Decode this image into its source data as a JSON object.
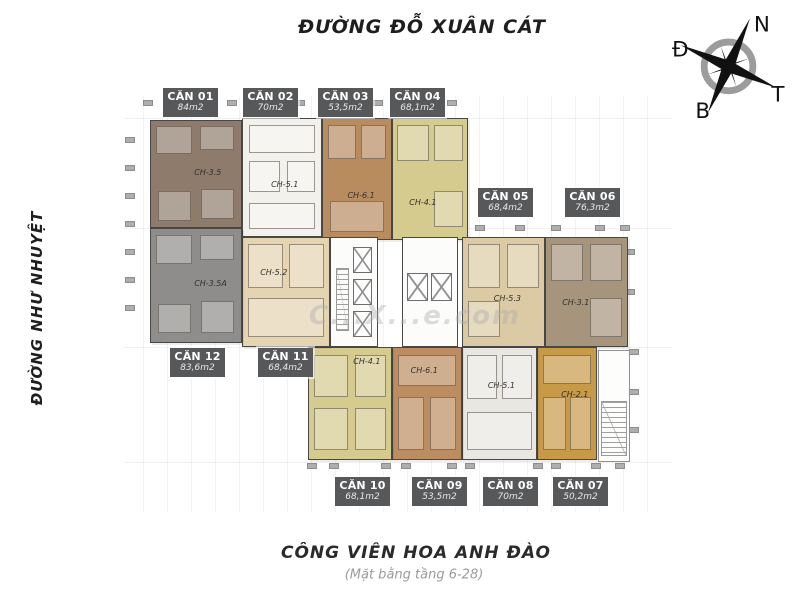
{
  "streets": {
    "top": "ĐƯỜNG ĐỖ XUÂN CÁT",
    "left": "ĐƯỜNG NHƯ NHUYỆT",
    "park": "CÔNG VIÊN HOA ANH ĐÀO",
    "floor_note": "(Mặt bằng tầng 6-28)"
  },
  "compass": {
    "label_top": "N",
    "label_left": "Đ",
    "label_right": "T",
    "label_bottom": "B"
  },
  "watermark": {
    "text": "C...X...e.com"
  },
  "palette": {
    "label_box": "#57585a",
    "wall": "#474747",
    "tick": "#aeaeae"
  },
  "units": [
    {
      "id": "01",
      "name": "CĂN 01",
      "area": "84m2",
      "code": "CH-3.5",
      "label": {
        "x": 163,
        "y": 88
      },
      "plan": {
        "x": 150,
        "y": 120,
        "w": 92,
        "h": 108,
        "color": "#8e7b6b"
      },
      "code_pos": {
        "l": 48,
        "t": 44
      },
      "rooms": [
        [
          6,
          5,
          40,
          26
        ],
        [
          54,
          5,
          38,
          22
        ],
        [
          8,
          66,
          36,
          28
        ],
        [
          56,
          64,
          36,
          28
        ]
      ]
    },
    {
      "id": "02",
      "name": "CĂN 02",
      "area": "70m2",
      "code": "CH-5.1",
      "label": {
        "x": 243,
        "y": 88
      },
      "plan": {
        "x": 242,
        "y": 118,
        "w": 80,
        "h": 119,
        "color": "#f3f1ec"
      },
      "code_pos": {
        "l": 36,
        "t": 52
      },
      "rooms": [
        [
          8,
          5,
          84,
          24
        ],
        [
          8,
          36,
          40,
          26
        ],
        [
          56,
          36,
          36,
          26
        ],
        [
          8,
          72,
          84,
          22
        ]
      ]
    },
    {
      "id": "03",
      "name": "CĂN 03",
      "area": "53,5m2",
      "code": "CH-6.1",
      "label": {
        "x": 318,
        "y": 88
      },
      "plan": {
        "x": 322,
        "y": 118,
        "w": 70,
        "h": 122,
        "color": "#b98c60"
      },
      "code_pos": {
        "l": 36,
        "t": 60
      },
      "rooms": [
        [
          8,
          5,
          40,
          28
        ],
        [
          56,
          5,
          36,
          28
        ],
        [
          10,
          68,
          80,
          26
        ]
      ]
    },
    {
      "id": "04",
      "name": "CĂN 04",
      "area": "68,1m2",
      "code": "CH-4.1",
      "label": {
        "x": 390,
        "y": 88
      },
      "plan": {
        "x": 392,
        "y": 118,
        "w": 76,
        "h": 122,
        "color": "#d5cb8e"
      },
      "code_pos": {
        "l": 22,
        "t": 66
      },
      "rooms": [
        [
          6,
          5,
          42,
          30
        ],
        [
          56,
          5,
          38,
          30
        ],
        [
          56,
          60,
          38,
          30
        ]
      ]
    },
    {
      "id": "05",
      "name": "CĂN 05",
      "area": "68,4m2",
      "code": "CH-5.3",
      "label": {
        "x": 478,
        "y": 188
      },
      "plan": {
        "x": 462,
        "y": 237,
        "w": 83,
        "h": 110,
        "color": "#dbcaa4"
      },
      "code_pos": {
        "l": 38,
        "t": 52
      },
      "rooms": [
        [
          6,
          6,
          40,
          40
        ],
        [
          54,
          6,
          40,
          40
        ],
        [
          6,
          58,
          40,
          34
        ]
      ]
    },
    {
      "id": "06",
      "name": "CĂN 06",
      "area": "76,3m2",
      "code": "CH-3.1",
      "label": {
        "x": 565,
        "y": 188
      },
      "plan": {
        "x": 545,
        "y": 237,
        "w": 83,
        "h": 110,
        "color": "#a6947d"
      },
      "code_pos": {
        "l": 20,
        "t": 56
      },
      "rooms": [
        [
          6,
          6,
          40,
          34
        ],
        [
          54,
          6,
          40,
          34
        ],
        [
          54,
          56,
          40,
          36
        ]
      ]
    },
    {
      "id": "07",
      "name": "CĂN 07",
      "area": "50,2m2",
      "code": "CH-2.1",
      "label": {
        "x": 553,
        "y": 477
      },
      "plan": {
        "x": 537,
        "y": 347,
        "w": 60,
        "h": 113,
        "color": "#c79a47"
      },
      "code_pos": {
        "l": 40,
        "t": 38
      },
      "rooms": [
        [
          8,
          6,
          84,
          26
        ],
        [
          8,
          44,
          40,
          48
        ],
        [
          56,
          44,
          36,
          48
        ]
      ]
    },
    {
      "id": "08",
      "name": "CĂN 08",
      "area": "70m2",
      "code": "CH-5.1",
      "label": {
        "x": 483,
        "y": 477
      },
      "plan": {
        "x": 462,
        "y": 347,
        "w": 75,
        "h": 113,
        "color": "#e9e7e1"
      },
      "code_pos": {
        "l": 34,
        "t": 30
      },
      "rooms": [
        [
          6,
          6,
          40,
          40
        ],
        [
          54,
          6,
          40,
          40
        ],
        [
          6,
          58,
          88,
          34
        ]
      ]
    },
    {
      "id": "09",
      "name": "CĂN 09",
      "area": "53,5m2",
      "code": "CH-6.1",
      "label": {
        "x": 412,
        "y": 477
      },
      "plan": {
        "x": 392,
        "y": 347,
        "w": 70,
        "h": 113,
        "color": "#bb8d60"
      },
      "code_pos": {
        "l": 26,
        "t": 16
      },
      "rooms": [
        [
          8,
          6,
          84,
          28
        ],
        [
          8,
          44,
          38,
          48
        ],
        [
          54,
          44,
          38,
          48
        ]
      ]
    },
    {
      "id": "10",
      "name": "CĂN 10",
      "area": "68,1m2",
      "code": "CH-4.1",
      "label": {
        "x": 335,
        "y": 477
      },
      "plan": {
        "x": 308,
        "y": 347,
        "w": 84,
        "h": 113,
        "color": "#d5cb8e"
      },
      "code_pos": {
        "l": 54,
        "t": 8
      },
      "rooms": [
        [
          6,
          6,
          42,
          38
        ],
        [
          56,
          6,
          38,
          38
        ],
        [
          6,
          54,
          42,
          38
        ],
        [
          56,
          54,
          38,
          38
        ]
      ]
    },
    {
      "id": "11",
      "name": "CĂN 11",
      "area": "68,4m2",
      "code": "CH-5.2",
      "label": {
        "x": 258,
        "y": 348
      },
      "plan": {
        "x": 242,
        "y": 237,
        "w": 88,
        "h": 110,
        "color": "#e4d5b0"
      },
      "code_pos": {
        "l": 20,
        "t": 28
      },
      "rooms": [
        [
          6,
          6,
          40,
          40
        ],
        [
          54,
          6,
          40,
          40
        ],
        [
          6,
          56,
          88,
          36
        ]
      ]
    },
    {
      "id": "12",
      "name": "CĂN 12",
      "area": "83,6m2",
      "code": "CH-3.5A",
      "label": {
        "x": 170,
        "y": 348
      },
      "plan": {
        "x": 150,
        "y": 228,
        "w": 92,
        "h": 115,
        "color": "#8f8d8b"
      },
      "code_pos": {
        "l": 48,
        "t": 44
      },
      "rooms": [
        [
          6,
          5,
          40,
          26
        ],
        [
          54,
          5,
          38,
          22
        ],
        [
          8,
          66,
          36,
          26
        ],
        [
          56,
          64,
          36,
          28
        ]
      ]
    }
  ],
  "cores": [
    {
      "x": 330,
      "y": 237,
      "w": 48,
      "h": 110,
      "shafts": [
        [
          48,
          8,
          42,
          24
        ],
        [
          48,
          38,
          42,
          24
        ],
        [
          48,
          68,
          42,
          24
        ]
      ],
      "stair": [
        10,
        28,
        30,
        58
      ]
    },
    {
      "x": 402,
      "y": 237,
      "w": 56,
      "h": 110,
      "shafts": [
        [
          8,
          32,
          38,
          26
        ],
        [
          52,
          32,
          38,
          26
        ]
      ],
      "stair": null
    }
  ],
  "ext_stair": {
    "x": 598,
    "y": 350,
    "w": 32,
    "h": 112
  },
  "grid": {
    "v": [
      143,
      167,
      191,
      215,
      239,
      263,
      287,
      311,
      335,
      359,
      383,
      407,
      431,
      455,
      479,
      503,
      527,
      551,
      575,
      599,
      623,
      647
    ],
    "h": [
      118,
      228,
      347,
      462
    ],
    "v_top": 96,
    "v_bottom": 512,
    "h_left": 124,
    "h_right": 672
  },
  "ticks": [
    [
      130,
      140
    ],
    [
      130,
      168
    ],
    [
      130,
      196
    ],
    [
      130,
      224
    ],
    [
      130,
      252
    ],
    [
      130,
      280
    ],
    [
      130,
      308
    ],
    [
      148,
      103
    ],
    [
      196,
      103
    ],
    [
      232,
      103
    ],
    [
      258,
      103
    ],
    [
      300,
      103
    ],
    [
      330,
      103
    ],
    [
      352,
      103
    ],
    [
      378,
      103
    ],
    [
      404,
      103
    ],
    [
      430,
      103
    ],
    [
      452,
      103
    ],
    [
      480,
      228
    ],
    [
      520,
      228
    ],
    [
      556,
      228
    ],
    [
      600,
      228
    ],
    [
      625,
      228
    ],
    [
      630,
      252
    ],
    [
      630,
      292
    ],
    [
      634,
      352
    ],
    [
      634,
      392
    ],
    [
      634,
      430
    ],
    [
      312,
      466
    ],
    [
      334,
      466
    ],
    [
      386,
      466
    ],
    [
      406,
      466
    ],
    [
      452,
      466
    ],
    [
      470,
      466
    ],
    [
      538,
      466
    ],
    [
      556,
      466
    ],
    [
      596,
      466
    ],
    [
      620,
      466
    ]
  ]
}
